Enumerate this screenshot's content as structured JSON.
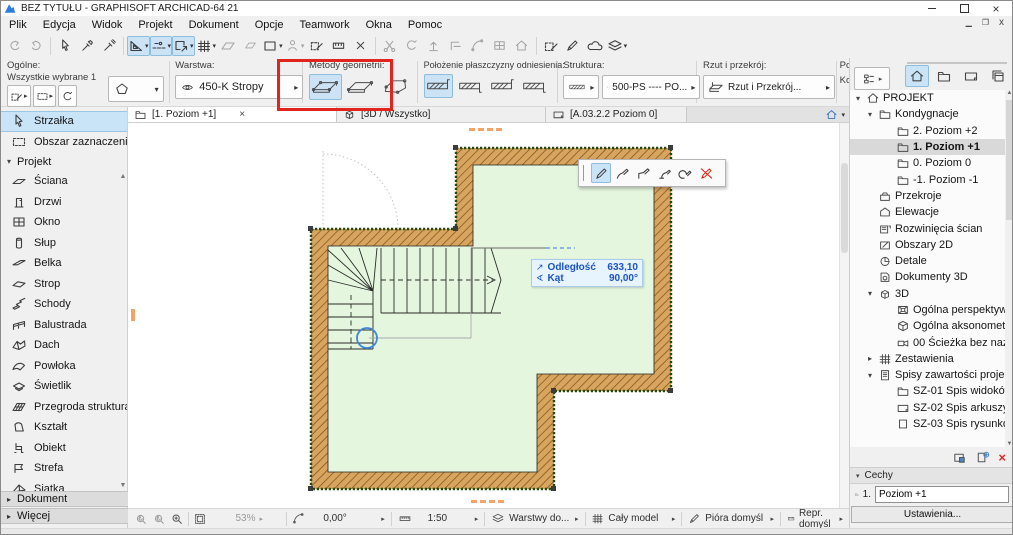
{
  "window": {
    "title": "BEZ TYTUŁU - GRAPHISOFT ARCHICAD-64 21"
  },
  "menu": {
    "items": [
      {
        "label": "Plik"
      },
      {
        "label": "Edycja"
      },
      {
        "label": "Widok"
      },
      {
        "label": "Projekt"
      },
      {
        "label": "Dokument"
      },
      {
        "label": "Opcje"
      },
      {
        "label": "Teamwork"
      },
      {
        "label": "Okna"
      },
      {
        "label": "Pomoc"
      }
    ]
  },
  "infobar": {
    "general": {
      "label": "Ogólne:",
      "sub": "Wszystkie wybrane 1"
    },
    "layer": {
      "label": "Warstwa:",
      "value": "450-K Stropy"
    },
    "geometry": {
      "label": "Metody geometrii:"
    },
    "plane": {
      "label": "Położenie płaszczyzny odniesienia:"
    },
    "structure": {
      "label": "Struktura:",
      "value": "500-PS ---- PO..."
    },
    "view": {
      "label": "Rzut i przekrój:",
      "value": "Rzut i Przekrój..."
    },
    "clipped": {
      "top": "Powi",
      "bottom": "Kon"
    }
  },
  "toolbox": {
    "arrow": "Strzałka",
    "marquee": "Obszar zaznaczenia",
    "group": "Projekt",
    "tools": [
      {
        "label": "Ściana",
        "icon": "#x-wall"
      },
      {
        "label": "Drzwi",
        "icon": "#x-door"
      },
      {
        "label": "Okno",
        "icon": "#s-win"
      },
      {
        "label": "Słup",
        "icon": "#x-column"
      },
      {
        "label": "Belka",
        "icon": "#x-beam"
      },
      {
        "label": "Strop",
        "icon": "#x-slab"
      },
      {
        "label": "Schody",
        "icon": "#x-stairs"
      },
      {
        "label": "Balustrada",
        "icon": "#x-rail"
      },
      {
        "label": "Dach",
        "icon": "#x-roof"
      },
      {
        "label": "Powłoka",
        "icon": "#x-shell"
      },
      {
        "label": "Świetlik",
        "icon": "#x-sky"
      },
      {
        "label": "Przegroda strukturalna",
        "icon": "#x-cwall"
      },
      {
        "label": "Kształt",
        "icon": "#x-morph"
      },
      {
        "label": "Obiekt",
        "icon": "#x-object"
      },
      {
        "label": "Strefa",
        "icon": "#x-zone"
      },
      {
        "label": "Siatka",
        "icon": "#x-mesh"
      }
    ],
    "bottom": [
      {
        "label": "Dokument"
      },
      {
        "label": "Więcej"
      }
    ]
  },
  "tabs": {
    "items": [
      {
        "label": "[1. Poziom +1]",
        "icon": "#t-stories",
        "active": true,
        "close": "×"
      },
      {
        "label": "[3D / Wszystko]",
        "icon": "#t-cube"
      },
      {
        "label": "[A.03.2.2 Poziom 0]",
        "icon": "#t-sheetL"
      }
    ]
  },
  "tracker": {
    "distance_label": "Odległość",
    "distance_value": "633,10",
    "angle_label": "Kąt",
    "angle_value": "90,00°"
  },
  "navigator": {
    "tree": [
      {
        "label": "PROJEKT",
        "lv": 0,
        "icon": "#s-home",
        "arrow": "▾"
      },
      {
        "label": "Kondygnacje",
        "lv": 1,
        "icon": "#t-stories",
        "arrow": "▾"
      },
      {
        "label": "2. Poziom +2",
        "lv": 2,
        "icon": "#t-stories",
        "arrow": ""
      },
      {
        "label": "1. Poziom +1",
        "lv": 2,
        "icon": "#t-stories",
        "arrow": "",
        "selected": true
      },
      {
        "label": "0. Poziom 0",
        "lv": 2,
        "icon": "#t-stories",
        "arrow": ""
      },
      {
        "label": "-1. Poziom -1",
        "lv": 2,
        "icon": "#t-stories",
        "arrow": ""
      },
      {
        "label": "Przekroje",
        "lv": 1,
        "icon": "#t-case",
        "arrow": ""
      },
      {
        "label": "Elewacje",
        "lv": 1,
        "icon": "#t-elev",
        "arrow": ""
      },
      {
        "label": "Rozwinięcia ścian",
        "lv": 1,
        "icon": "#t-ie",
        "arrow": ""
      },
      {
        "label": "Obszary 2D",
        "lv": 1,
        "icon": "#t-area",
        "arrow": ""
      },
      {
        "label": "Detale",
        "lv": 1,
        "icon": "#t-detail",
        "arrow": ""
      },
      {
        "label": "Dokumenty 3D",
        "lv": 1,
        "icon": "#t-d3",
        "arrow": ""
      },
      {
        "label": "3D",
        "lv": 1,
        "icon": "#t-cube",
        "arrow": "▾"
      },
      {
        "label": "Ogólna perspektywa",
        "lv": 2,
        "icon": "#t-persp",
        "arrow": ""
      },
      {
        "label": "Ogólna aksonometria",
        "lv": 2,
        "icon": "#t-axon",
        "arrow": ""
      },
      {
        "label": "00 Ścieżka bez nazwy",
        "lv": 2,
        "icon": "#t-cam",
        "arrow": ""
      },
      {
        "label": "Zestawienia",
        "lv": 1,
        "icon": "#s-grid",
        "arrow": "▸"
      },
      {
        "label": "Spisy zawartości projektu",
        "lv": 1,
        "icon": "#t-toc",
        "arrow": "▾"
      },
      {
        "label": "SZ-01 Spis widoków",
        "lv": 2,
        "icon": "#t-stories",
        "arrow": ""
      },
      {
        "label": "SZ-02 Spis arkuszy",
        "lv": 2,
        "icon": "#t-sheetL",
        "arrow": ""
      },
      {
        "label": "SZ-03 Spis rysunków",
        "lv": 2,
        "icon": "#t-pageP",
        "arrow": ""
      }
    ],
    "properties": {
      "header": "Cechy",
      "story_no": "1.",
      "story_name": "Poziom +1",
      "settings": "Ustawienia..."
    }
  },
  "statusbar": {
    "zoom": "53%",
    "angle": "0,00°",
    "scale": "1:50",
    "layers": "Warstwy do...",
    "model": "Cały model",
    "pens": "Pióra domyśl",
    "repr": "Repr. domyśl"
  }
}
